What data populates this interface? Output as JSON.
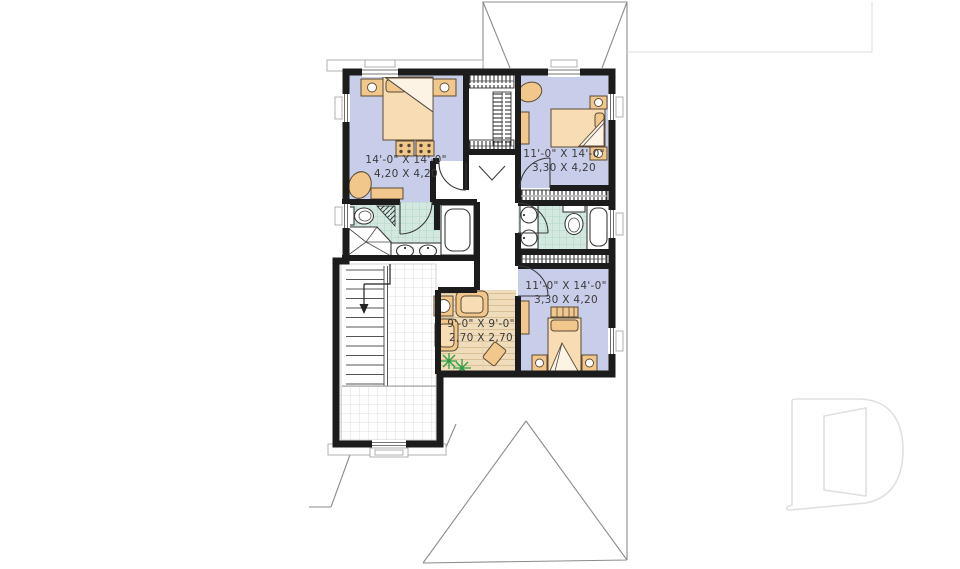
{
  "plan": {
    "rooms": {
      "bedroom_master": {
        "imperial": "14'-0\" X 14'-0\"",
        "metric": "4,20 X 4,20"
      },
      "bedroom_2": {
        "imperial": "11'-0\" X 14'-0\"",
        "metric": "3,30 X 4,20"
      },
      "bedroom_3": {
        "imperial": "11'-0\" X 14'-0\"",
        "metric": "3,30 X 4,20"
      },
      "family_room": {
        "imperial": "9'-0\" X 9'-0\"",
        "metric": "2,70 X 2,70"
      }
    },
    "colors": {
      "wall": "#1c1c1c",
      "carpet": "#c8cde9",
      "bath_tile": "#d3e9e0",
      "wood_floor": "#eedcba",
      "furniture": "#f2c78c",
      "roof_line": "#8c8c8c",
      "plant": "#2e9e44",
      "watermark": "#e0e0e0"
    }
  },
  "watermark": {
    "label": "D"
  }
}
